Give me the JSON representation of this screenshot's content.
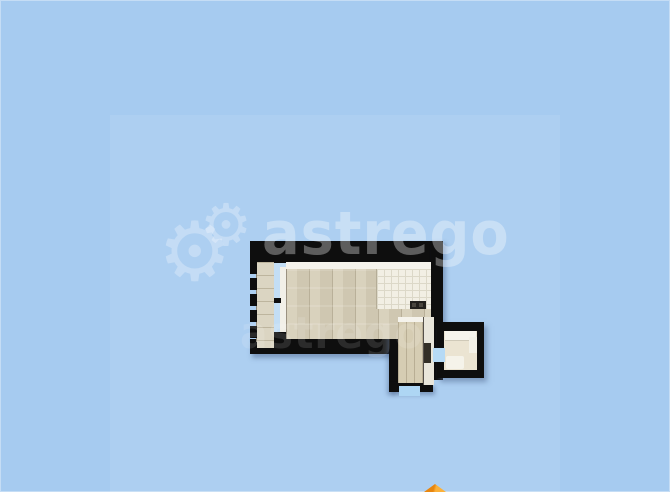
{
  "watermark": {
    "brand_text": "astrego",
    "secondary_text": "astrego",
    "gear_icon_glyph": "⚙"
  },
  "colors": {
    "background": "#a6cbf0",
    "overlay_panel": "rgba(255,255,255,0.085)",
    "walls": "#0e0e0e",
    "living_room_floor": "#d8d1bc",
    "kitchen_tile_floor": "#f2efe4",
    "balcony_floor": "#dbd5c2",
    "corridor_floor": "#d6cdb3",
    "bathroom_floor": "#ebe4d2",
    "window_glass": "#c3def5",
    "door_opening": "#b6daf5",
    "north_arrow": "#f7a11c"
  }
}
